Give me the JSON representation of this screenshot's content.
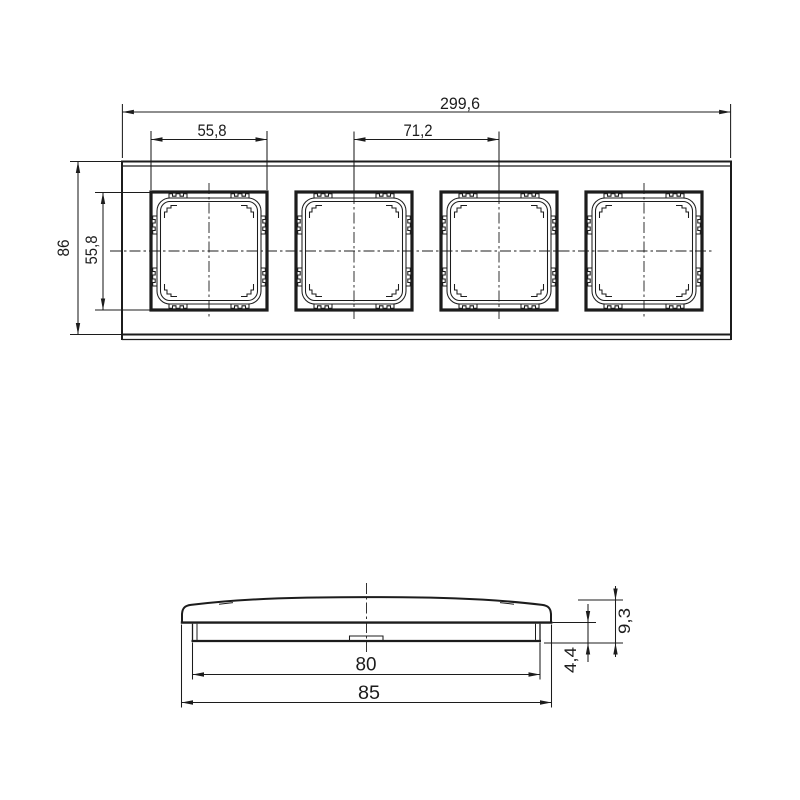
{
  "colors": {
    "background": "#ffffff",
    "line": "#1c1c1c"
  },
  "drawing": {
    "kind": "technical-drawing",
    "front_view": {
      "openings_count": 4,
      "dims": {
        "total_width": "299,6",
        "opening_width": "55,8",
        "center_spacing": "71,2",
        "frame_height": "86",
        "opening_height": "55,8"
      }
    },
    "side_view": {
      "dims": {
        "inner_width": "80",
        "outer_width": "85",
        "total_height": "9,3",
        "base_height": "4,4"
      }
    }
  }
}
